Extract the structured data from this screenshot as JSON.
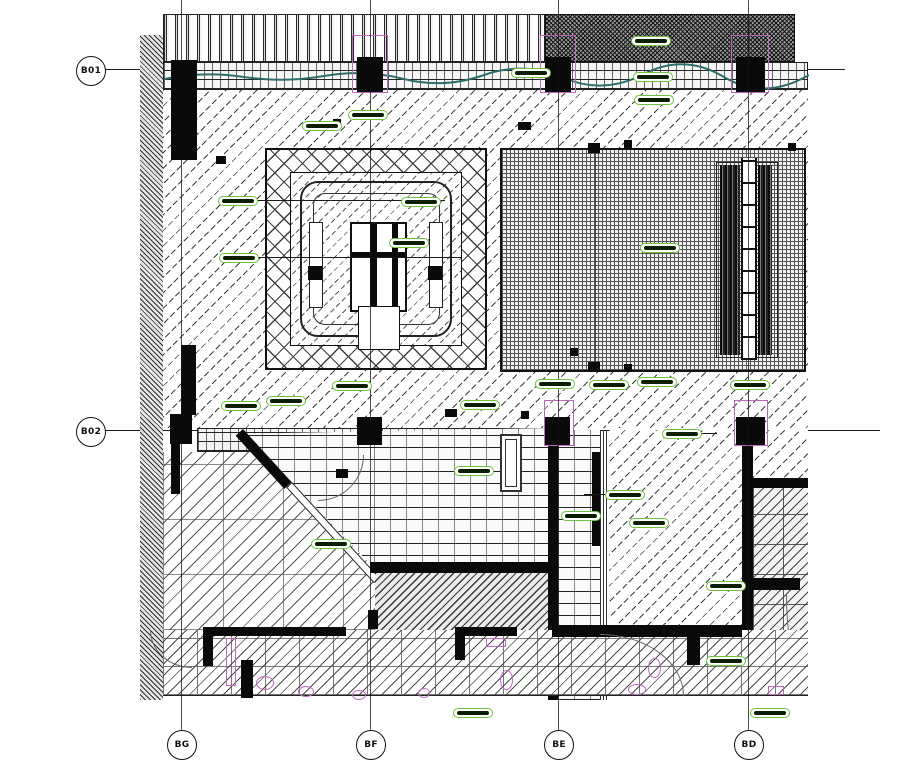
{
  "canvas": {
    "width": 920,
    "height": 763
  },
  "grid_bubbles": {
    "left": [
      {
        "label": "B01",
        "cx": 90,
        "cy": 70
      },
      {
        "label": "B02",
        "cx": 90,
        "cy": 431
      }
    ],
    "bottom": [
      {
        "label": "BG",
        "cx": 181,
        "cy": 744
      },
      {
        "label": "BF",
        "cx": 370,
        "cy": 744
      },
      {
        "label": "BE",
        "cx": 558,
        "cy": 744
      },
      {
        "label": "BD",
        "cx": 748,
        "cy": 744
      }
    ]
  },
  "colors": {
    "highlight_green": "#6dc33e",
    "highlight_fill": "#0a1f00",
    "magenta": "#bd68bd",
    "teal": "#2d6e6a",
    "ink": "#111111"
  },
  "highlights": {
    "pills": [
      [
        322,
        126
      ],
      [
        368,
        115
      ],
      [
        531,
        73
      ],
      [
        651,
        41
      ],
      [
        653,
        77
      ],
      [
        654,
        100
      ],
      [
        238,
        201
      ],
      [
        239,
        258
      ],
      [
        421,
        202
      ],
      [
        409,
        243
      ],
      [
        660,
        248
      ],
      [
        241,
        406
      ],
      [
        286,
        401
      ],
      [
        352,
        386
      ],
      [
        480,
        405
      ],
      [
        555,
        384
      ],
      [
        609,
        385
      ],
      [
        657,
        382
      ],
      [
        750,
        385
      ],
      [
        682,
        434
      ],
      [
        474,
        471
      ],
      [
        581,
        516
      ],
      [
        625,
        495
      ],
      [
        649,
        523
      ],
      [
        331,
        544
      ],
      [
        726,
        586
      ],
      [
        726,
        661
      ],
      [
        473,
        713
      ],
      [
        770,
        713
      ]
    ]
  },
  "fixtures": {
    "magenta_shapes": [
      [
        226,
        638,
        10,
        48,
        "r"
      ],
      [
        256,
        676,
        18,
        14,
        "e"
      ],
      [
        298,
        686,
        16,
        11,
        "e"
      ],
      [
        486,
        638,
        20,
        9,
        "r"
      ],
      [
        500,
        670,
        13,
        20,
        "e"
      ],
      [
        628,
        684,
        18,
        11,
        "e"
      ],
      [
        648,
        658,
        13,
        20,
        "e"
      ],
      [
        768,
        686,
        16,
        9,
        "r"
      ],
      [
        352,
        690,
        14,
        10,
        "e"
      ],
      [
        418,
        688,
        12,
        10,
        "e"
      ]
    ],
    "magenta_boxes": [
      [
        352,
        35,
        36,
        58
      ],
      [
        540,
        35,
        36,
        58
      ],
      [
        731,
        35,
        38,
        58
      ],
      [
        544,
        400,
        30,
        46
      ],
      [
        734,
        400,
        34,
        46
      ]
    ]
  },
  "wall_blocks": [
    [
      518,
      122,
      13,
      8
    ],
    [
      216,
      156,
      10,
      8
    ],
    [
      588,
      143,
      12,
      10
    ],
    [
      588,
      362,
      12,
      10
    ],
    [
      333,
      119,
      8,
      8
    ],
    [
      445,
      409,
      12,
      8
    ],
    [
      336,
      469,
      12,
      9
    ],
    [
      521,
      411,
      8,
      8
    ],
    [
      570,
      348,
      8,
      8
    ],
    [
      788,
      143,
      8,
      8
    ],
    [
      624,
      140,
      8,
      8
    ],
    [
      624,
      364,
      8,
      8
    ]
  ]
}
